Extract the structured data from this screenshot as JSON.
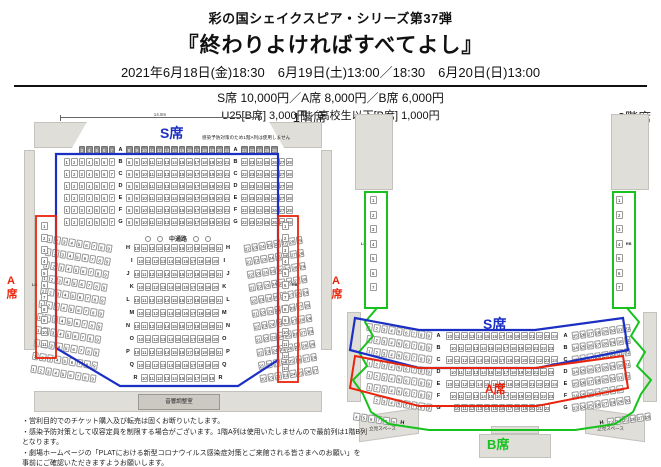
{
  "header": {
    "series": "彩の国シェイクスピア・シリーズ第37弾",
    "title": "『終わりよければすべてよし』",
    "dates": "2021年6月18日(金)18:30　6月19日(土)13:00／18:30　6月20日(日)13:00",
    "prices_main": "S席 10,000円／A席 8,000円／B席 6,000円",
    "prices_sub": "U25[B席] 3,000円／高校生以下[B席] 1,000円"
  },
  "colors": {
    "s_seat": "#1b2fc4",
    "a_seat": "#e8250c",
    "b_seat": "#17c21e"
  },
  "floor1": {
    "label": "1階席",
    "stage_width": "14.9m",
    "s_label": "S席",
    "s_note": "感染予防対策のため1階A列は使用しません",
    "a_label_left": "A席",
    "a_label_right": "A席",
    "aisle": "中通路",
    "sound_room": "音響調整室",
    "lb": "LB",
    "rb": "RB",
    "left_col": {
      "from": 1,
      "to": 11,
      "label_at": 6
    },
    "right_col": {
      "from": 1,
      "to": 13,
      "label_at": 6
    },
    "front_rows": [
      {
        "letter": "A",
        "left": [
          3,
          7
        ],
        "mid": [
          8,
          21
        ],
        "right": [
          22,
          26
        ],
        "disabled": true,
        "pad_left": 2,
        "pad_right": 2
      },
      {
        "letter": "B",
        "left": [
          1,
          7
        ],
        "mid": [
          8,
          21
        ],
        "right": [
          22,
          28
        ]
      },
      {
        "letter": "C",
        "left": [
          1,
          7
        ],
        "mid": [
          8,
          21
        ],
        "right": [
          22,
          28
        ]
      },
      {
        "letter": "D",
        "left": [
          1,
          7
        ],
        "mid": [
          8,
          21
        ],
        "right": [
          22,
          28
        ]
      },
      {
        "letter": "E",
        "left": [
          1,
          7
        ],
        "mid": [
          8,
          21
        ],
        "right": [
          22,
          28
        ]
      },
      {
        "letter": "F",
        "left": [
          1,
          7
        ],
        "mid": [
          8,
          21
        ],
        "right": [
          22,
          28
        ]
      },
      {
        "letter": "G",
        "left": [
          1,
          7
        ],
        "mid": [
          8,
          21
        ],
        "right": [
          22,
          28
        ]
      }
    ],
    "rear_rows": [
      {
        "letter": "H",
        "wl": [
          1,
          9
        ],
        "mid": [
          10,
          21
        ],
        "wr": [
          22,
          29
        ]
      },
      {
        "letter": "I",
        "wl": [
          1,
          9
        ],
        "mid": [
          10,
          20
        ],
        "wr": [
          21,
          28
        ]
      },
      {
        "letter": "J",
        "wl": [
          1,
          9
        ],
        "mid": [
          10,
          21
        ],
        "wr": [
          22,
          29
        ]
      },
      {
        "letter": "K",
        "wl": [
          1,
          9
        ],
        "mid": [
          10,
          20
        ],
        "wr": [
          21,
          28
        ]
      },
      {
        "letter": "L",
        "wl": [
          1,
          9
        ],
        "mid": [
          10,
          21
        ],
        "wr": [
          22,
          29
        ]
      },
      {
        "letter": "M",
        "wl": [
          1,
          9
        ],
        "mid": [
          10,
          20
        ],
        "wr": [
          21,
          28
        ]
      },
      {
        "letter": "N",
        "wl": [
          1,
          9
        ],
        "mid": [
          10,
          21
        ],
        "wr": [
          22,
          29
        ]
      },
      {
        "letter": "O",
        "wl": [
          1,
          9
        ],
        "mid": [
          10,
          20
        ],
        "wr": [
          21,
          28
        ]
      },
      {
        "letter": "P",
        "wl": [
          1,
          9
        ],
        "mid": [
          10,
          21
        ],
        "wr": [
          22,
          29
        ]
      },
      {
        "letter": "Q",
        "wl": [
          1,
          9
        ],
        "mid": [
          10,
          20
        ],
        "wr": [
          21,
          28
        ]
      },
      {
        "letter": "R",
        "wl": [
          1,
          9
        ],
        "mid": [
          10,
          19
        ],
        "wr": [
          20,
          27
        ]
      }
    ]
  },
  "floor2": {
    "label": "2階席",
    "s_label": "S席",
    "a_label": "A席",
    "b_label": "B席",
    "standing_left": "立見スペース",
    "standing_right": "立見スペース",
    "lb": "LB",
    "rb": "RB",
    "left_balcony": {
      "from": 1,
      "to": 7,
      "label_at": 4
    },
    "right_balcony": {
      "from": 1,
      "to": 7,
      "label_at": 4
    },
    "rows": [
      {
        "letter": "A",
        "wl": [
          1,
          9
        ],
        "mid": [
          10,
          24
        ],
        "wr": [
          25,
          32
        ]
      },
      {
        "letter": "B",
        "wl": [
          1,
          9
        ],
        "mid": [
          10,
          23
        ],
        "wr": [
          24,
          31
        ]
      },
      {
        "letter": "C",
        "wl": [
          1,
          9
        ],
        "mid": [
          10,
          24
        ],
        "wr": [
          25,
          32
        ]
      },
      {
        "letter": "D",
        "wl": [
          1,
          9
        ],
        "mid": [
          10,
          23
        ],
        "wr": [
          24,
          31
        ]
      },
      {
        "letter": "E",
        "wl": [
          1,
          9
        ],
        "mid": [
          10,
          24
        ],
        "wr": [
          25,
          32
        ]
      },
      {
        "letter": "F",
        "wl": [
          1,
          9
        ],
        "mid": [
          10,
          23
        ],
        "wr": [
          24,
          30
        ]
      },
      {
        "letter": "G",
        "wl": [
          2,
          9
        ],
        "mid": [
          10,
          22
        ],
        "wr": [
          23,
          30
        ]
      }
    ],
    "row_h": {
      "letter": "H",
      "wl": [
        4,
        9
      ],
      "wr": [
        23,
        28
      ]
    }
  },
  "notes": [
    "・営利目的でのチケット購入及び転売は固くお断りいたします。",
    "・感染予防対策として収容定員を制限する場合がございます。1階A列は使用いたしませんので最前列は1階B列となります。",
    "・劇場ホームページの「PLATにおける新型コロナウイルス感染症対策とご来館される皆さまへのお願い」を事前にご確認いただきますようお願いします。"
  ]
}
